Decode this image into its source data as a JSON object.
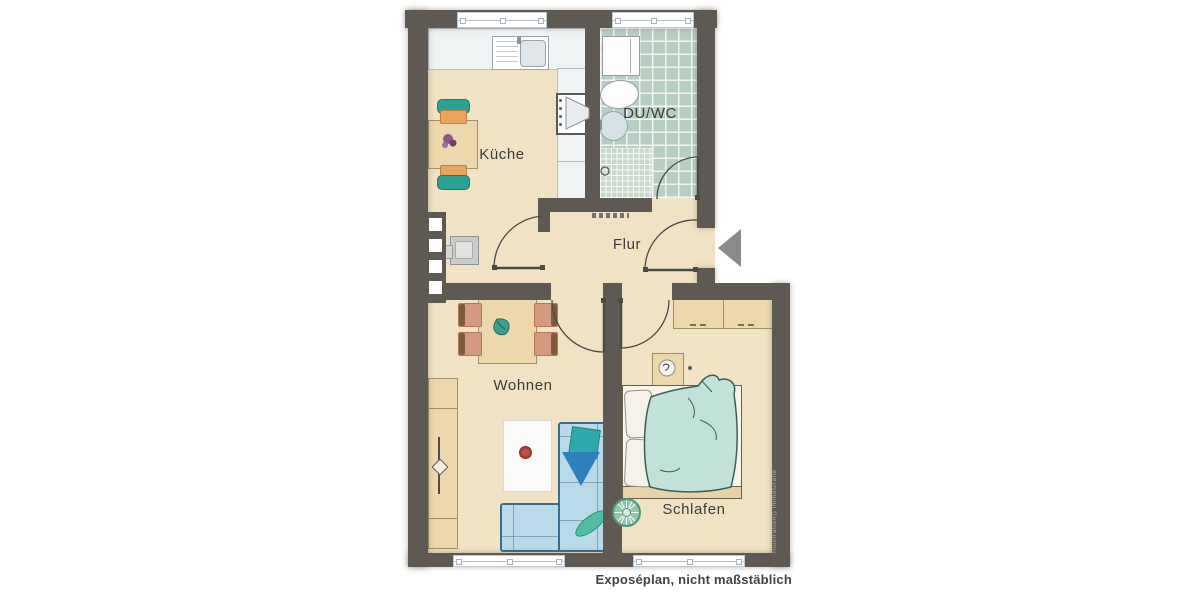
{
  "plan": {
    "rooms": [
      {
        "id": "kueche",
        "label": "Küche"
      },
      {
        "id": "du-wc",
        "label": "DU/WC"
      },
      {
        "id": "flur",
        "label": "Flur"
      },
      {
        "id": "wohnen",
        "label": "Wohnen"
      },
      {
        "id": "schlafen",
        "label": "Schlafen"
      }
    ],
    "caption": "Exposéplan, nicht maßstäblich",
    "watermark": "Illustration©ImmoGrafik",
    "entry": {
      "icon": "entry-arrow-left"
    },
    "colors": {
      "wall": "#5f5954",
      "floor": "#f1e2c3",
      "bath_tile": "#b7cec3",
      "wood_furniture": "#ecd8ac",
      "sofa_blue": "#b9dbe9",
      "duvet_teal": "#c2e1d9",
      "chair_teal": "#2ba093",
      "chair_orange": "#e9a55f",
      "entry_arrow_gray": "#8a8a8a"
    }
  }
}
